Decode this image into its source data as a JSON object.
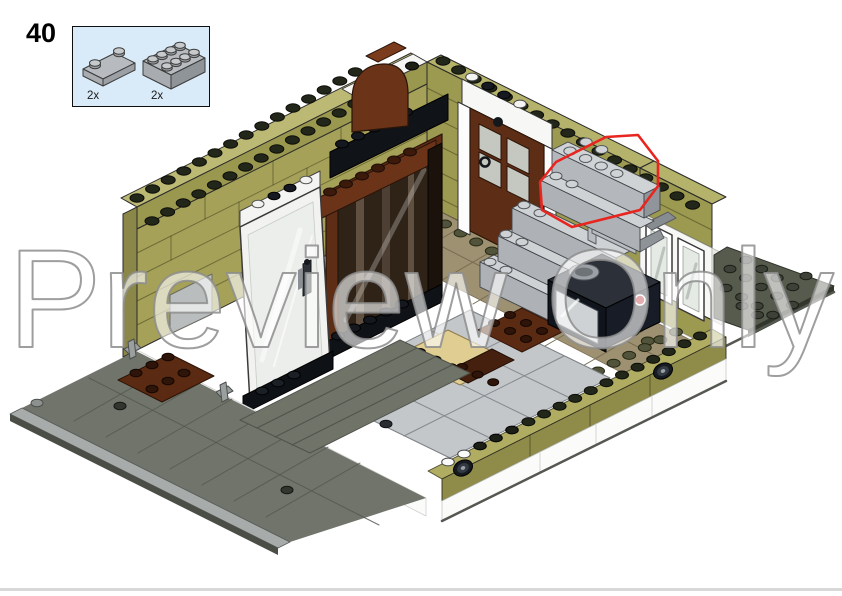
{
  "page": {
    "background": "#ffffff",
    "footer_rule_color": "#d8d8d8"
  },
  "step": {
    "number": "40"
  },
  "parts_callout": {
    "background": "#d9eaf8",
    "border_color": "#0f0f0f",
    "items": [
      {
        "quantity": "2x",
        "part_name": "plate-1x3-light-gray",
        "color_hex": "#a8acb0"
      },
      {
        "quantity": "2x",
        "part_name": "brick-2x4-light-gray",
        "color_hex": "#a8acb0"
      }
    ]
  },
  "watermark": {
    "text": "Preview Only",
    "fill": "#ffffff",
    "outline": "#8d8d8d"
  },
  "illustration": {
    "description": "Isometric LEGO step image: modular building corner with olive green walls, open glass door, reddish brown wardrobe, rear brown door with white frame, light gray stone chimney with tap, black stove, tiled interior floor, gray sidewalk with curb and dark gray baseplate",
    "highlight": {
      "color": "#e8251f",
      "meaning": "newly placed light gray 1x3 plates and 2x4 bricks"
    },
    "palette": {
      "olive_wall": "#a5a158",
      "olive_dark": "#8f8c4a",
      "olive_light": "#b5b26b",
      "reddish_brown": "#5d2d15",
      "dark_brown": "#46200e",
      "black": "#11141a",
      "light_gray_brick": "#b2b6ba",
      "gray_brick_top": "#cfd3d6",
      "baseplate_dark": "#575b4e",
      "sidewalk": "#70746a",
      "curb": "#a7abaa",
      "tan_floor": "#9e9171",
      "light_tan_plate": "#e0cd92",
      "tile_gray": "#c3c7ca",
      "white": "#fbfbf9",
      "glass": "#e9ede8"
    }
  }
}
